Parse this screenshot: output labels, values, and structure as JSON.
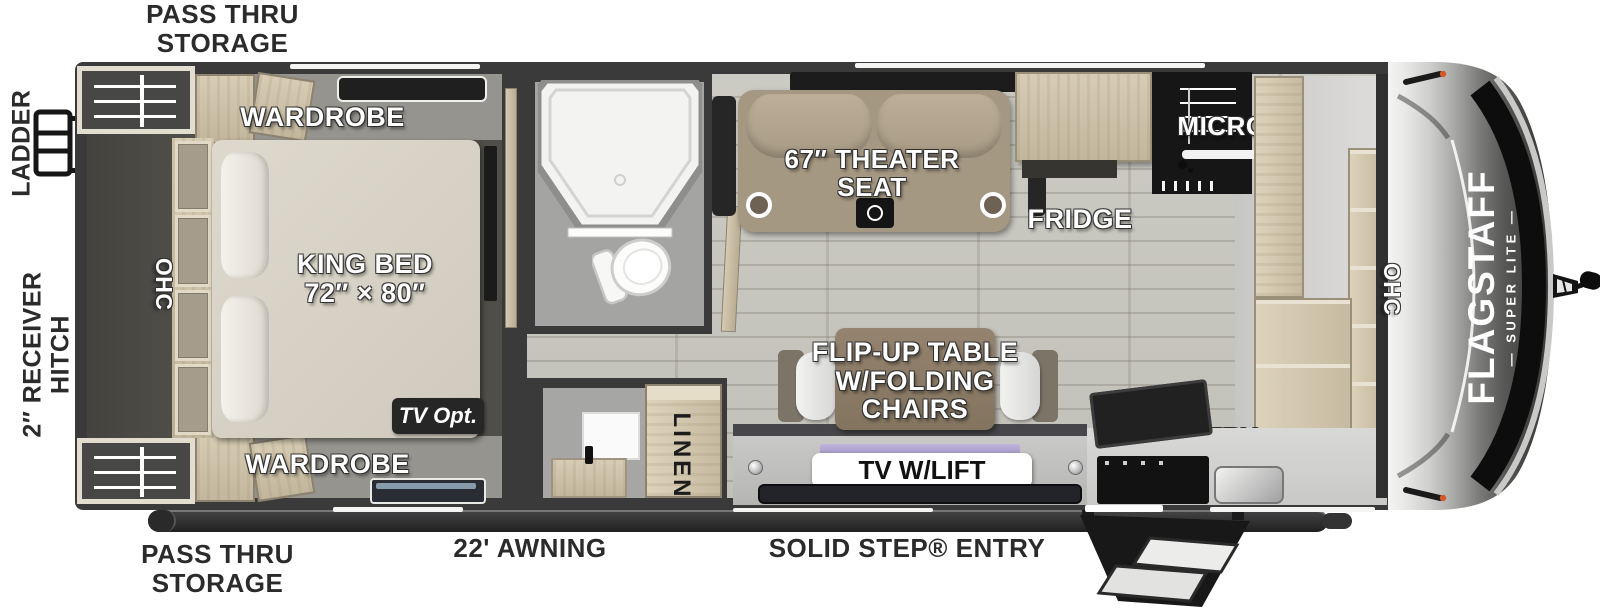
{
  "labels": {
    "pass_thru_top": {
      "line1": "PASS THRU",
      "line2": "STORAGE"
    },
    "pass_thru_bottom": {
      "line1": "PASS THRU",
      "line2": "STORAGE"
    },
    "ladder": "LADDER",
    "receiver_hitch": "2″ RECEIVER HITCH",
    "awning": "22' AWNING",
    "solid_step_entry": "SOLID STEP® ENTRY",
    "wardrobe_top": "WARDROBE",
    "wardrobe_bottom": "WARDROBE",
    "ohc_bedroom": "OHC",
    "ohc_front": "OHC",
    "king_bed": {
      "line1": "KING BED",
      "line2": "72″ × 80″"
    },
    "tv_opt": "TV Opt.",
    "theater_seat": {
      "line1": "67″ THEATER",
      "line2": "SEAT"
    },
    "fridge": "FRIDGE",
    "micro": "MICRO",
    "flip_table": {
      "line1": "FLIP-UP TABLE",
      "line2": "W/FOLDING",
      "line3": "CHAIRS"
    },
    "tv_lift": "TV W/LIFT",
    "linen": "LINEN",
    "pantry": "PANTRY",
    "brand": {
      "name": "FLAGSTAFF",
      "sub": "— SUPER LITE —"
    }
  },
  "colors": {
    "wall": "#3a3a3a",
    "wood_cabinet": "#cdc2a9",
    "wood_floor": "#c8c7bf",
    "bedroom_floor": "#53514b",
    "badge_dark": "#262626",
    "seat_tan": "#a59882",
    "table_brown": "#8a7a6c",
    "chrome_light": "#ececeb",
    "chrome_dark": "#3a3a38",
    "marker_orange": "#d4582a",
    "tv_accent_purple": "#aca2cc"
  }
}
